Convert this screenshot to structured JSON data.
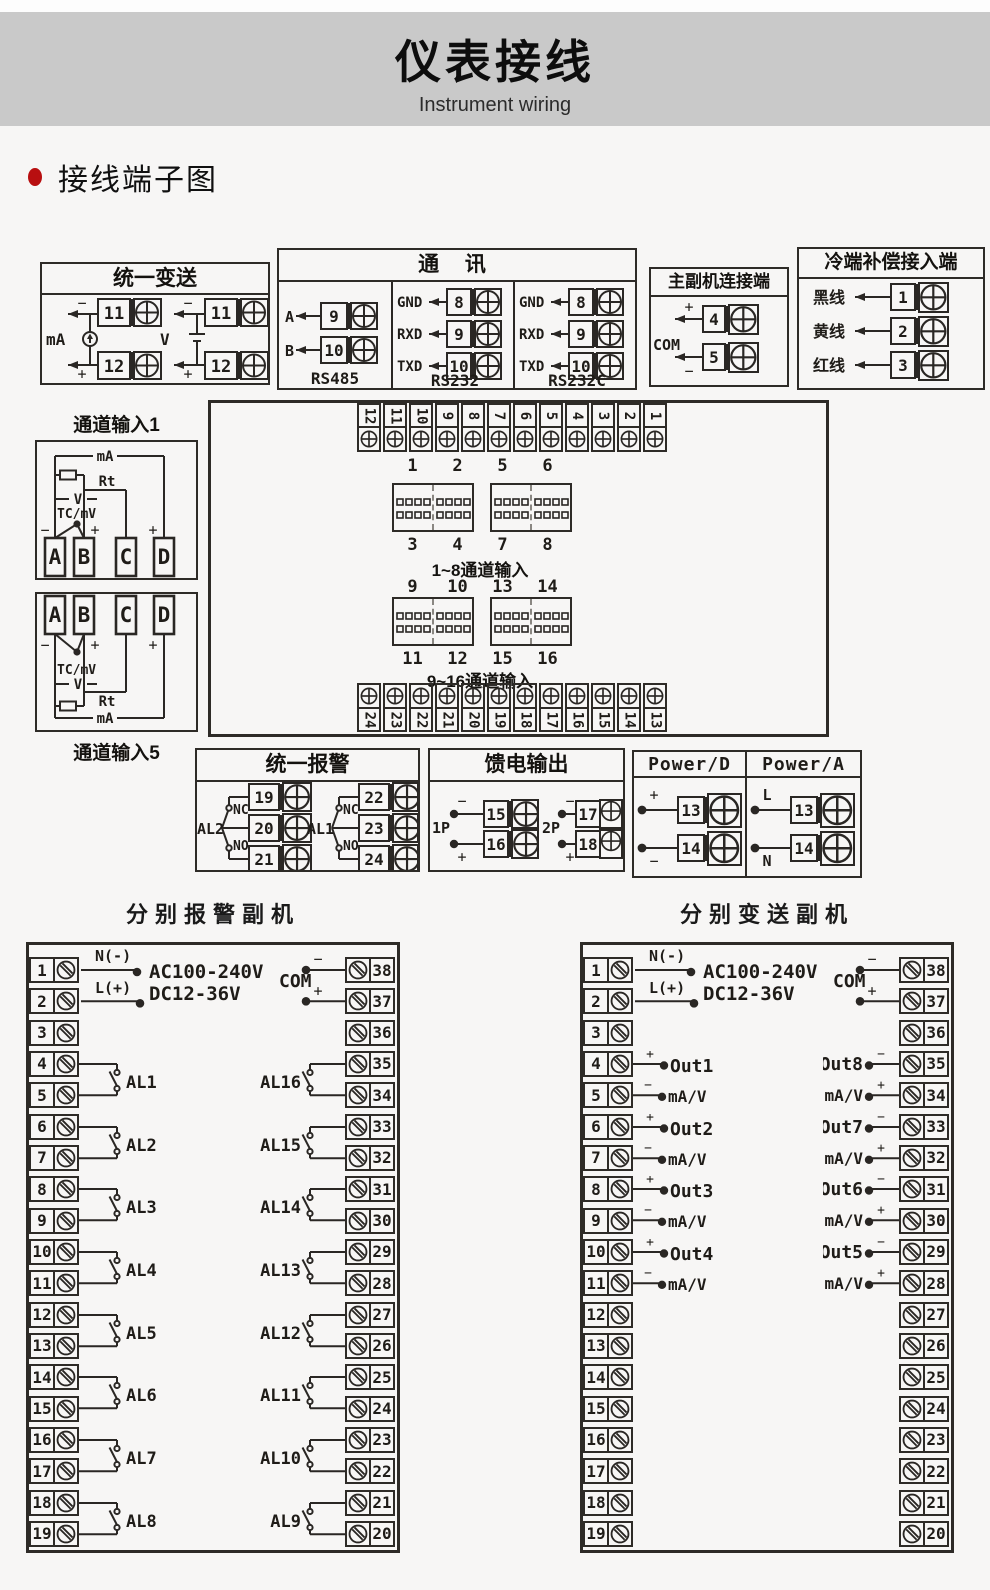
{
  "header": {
    "title": "仪表接线",
    "subtitle": "Instrument wiring"
  },
  "section_title": "接线端子图",
  "boxes": {
    "unified_transmit": {
      "title": "统一变送",
      "ma": {
        "label": "mA",
        "minus": "−",
        "plus": "+",
        "t1": "11",
        "t2": "12"
      },
      "v": {
        "label": "V",
        "minus": "−",
        "plus": "+",
        "t1": "11",
        "t2": "12"
      }
    },
    "comm": {
      "title": "通  讯",
      "rs485": {
        "name": "RS485",
        "rows": [
          {
            "label": "A",
            "num": "9"
          },
          {
            "label": "B",
            "num": "10"
          }
        ]
      },
      "rs232": {
        "name": "RS232",
        "rows": [
          {
            "label": "GND",
            "num": "8"
          },
          {
            "label": "RXD",
            "num": "9"
          },
          {
            "label": "TXD",
            "num": "10"
          }
        ]
      },
      "rs232c": {
        "name": "RS232C",
        "rows": [
          {
            "label": "GND",
            "num": "8"
          },
          {
            "label": "RXD",
            "num": "9"
          },
          {
            "label": "TXD",
            "num": "10"
          }
        ]
      }
    },
    "master_slave": {
      "title": "主副机连接端",
      "com": "COM",
      "plus": "+",
      "minus": "−",
      "t1": "4",
      "t2": "5"
    },
    "cold_comp": {
      "title": "冷端补偿接入端",
      "rows": [
        {
          "label": "黑线",
          "num": "1"
        },
        {
          "label": "黄线",
          "num": "2"
        },
        {
          "label": "红线",
          "num": "3"
        }
      ]
    },
    "channel1": {
      "title": "通道输入1",
      "ma": "mA",
      "rt": "Rt",
      "v": "V",
      "tc": "TC/mV",
      "minus": "−",
      "plus_b": "+",
      "plus_d": "+",
      "a": "A",
      "b": "B",
      "c": "C",
      "d": "D"
    },
    "channel5": {
      "title": "通道输入5",
      "ma": "mA",
      "rt": "Rt",
      "v": "V",
      "tc": "TC/mV",
      "minus": "−",
      "plus_b": "+",
      "plus_d": "+",
      "a": "A",
      "b": "B",
      "c": "C",
      "d": "D"
    },
    "mainboard": {
      "top_strip": [
        "12",
        "11",
        "10",
        "9",
        "8",
        "7",
        "6",
        "5",
        "4",
        "3",
        "2",
        "1"
      ],
      "bottom_strip": [
        "24",
        "23",
        "22",
        "21",
        "20",
        "19",
        "18",
        "17",
        "16",
        "15",
        "14",
        "13"
      ],
      "row1_top": [
        "1",
        "2",
        "5",
        "6"
      ],
      "row1_bottom": [
        "3",
        "4",
        "7",
        "8"
      ],
      "row1_caption": "1~8通道输入",
      "row2_top": [
        "9",
        "10",
        "13",
        "14"
      ],
      "row2_bottom": [
        "11",
        "12",
        "15",
        "16"
      ],
      "row2_caption": "9~16通道输入"
    },
    "unified_alarm": {
      "title": "统一报警",
      "g1": {
        "label": "AL2",
        "nc": "NC",
        "no": "NO",
        "t1": "19",
        "t2": "20",
        "t3": "21"
      },
      "g2": {
        "label": "AL1",
        "nc": "NC",
        "no": "NO",
        "t1": "22",
        "t2": "23",
        "t3": "24"
      }
    },
    "feed_output": {
      "title": "馈电输出",
      "g1": {
        "label": "1P",
        "minus": "−",
        "plus": "+",
        "t1": "15",
        "t2": "16"
      },
      "g2": {
        "label": "2P",
        "minus": "−",
        "plus": "+",
        "t1": "17",
        "t2": "18"
      }
    },
    "power": {
      "d_title": "Power/D",
      "a_title": "Power/A",
      "d": {
        "plus": "+",
        "minus": "−",
        "t1": "13",
        "t2": "14"
      },
      "a": {
        "l": "L",
        "n": "N",
        "t1": "13",
        "t2": "14"
      }
    }
  },
  "alarm_slave": {
    "title": "分别报警副机",
    "left_terminals": [
      "1",
      "2",
      "3",
      "4",
      "5",
      "6",
      "7",
      "8",
      "9",
      "10",
      "11",
      "12",
      "13",
      "14",
      "15",
      "16",
      "17",
      "18",
      "19"
    ],
    "right_terminals": [
      "38",
      "37",
      "36",
      "35",
      "34",
      "33",
      "32",
      "31",
      "30",
      "29",
      "28",
      "27",
      "26",
      "25",
      "24",
      "23",
      "22",
      "21",
      "20"
    ],
    "power": {
      "n_label": "N(-)",
      "l_label": "L(+)",
      "ac": "AC100-240V",
      "dc": "DC12-36V"
    },
    "com": {
      "label": "COM",
      "minus": "−",
      "plus": "+"
    },
    "left_alarms": [
      "AL1",
      "AL2",
      "AL3",
      "AL4",
      "AL5",
      "AL6",
      "AL7",
      "AL8"
    ],
    "right_alarms": [
      "AL16",
      "AL15",
      "AL14",
      "AL13",
      "AL12",
      "AL11",
      "AL10",
      "AL9"
    ]
  },
  "transmit_slave": {
    "title": "分别变送副机",
    "left_terminals": [
      "1",
      "2",
      "3",
      "4",
      "5",
      "6",
      "7",
      "8",
      "9",
      "10",
      "11",
      "12",
      "13",
      "14",
      "15",
      "16",
      "17",
      "18",
      "19"
    ],
    "right_terminals": [
      "38",
      "37",
      "36",
      "35",
      "34",
      "33",
      "32",
      "31",
      "30",
      "29",
      "28",
      "27",
      "26",
      "25",
      "24",
      "23",
      "22",
      "21",
      "20"
    ],
    "power": {
      "n_label": "N(-)",
      "l_label": "L(+)",
      "ac": "AC100-240V",
      "dc": "DC12-36V"
    },
    "com": {
      "label": "COM",
      "minus": "−",
      "plus": "+"
    },
    "left_outs": [
      {
        "plus": "+",
        "minus": "−",
        "label": "Out1",
        "mv": "mA/V"
      },
      {
        "plus": "+",
        "minus": "−",
        "label": "Out2",
        "mv": "mA/V"
      },
      {
        "plus": "+",
        "minus": "−",
        "label": "Out3",
        "mv": "mA/V"
      },
      {
        "plus": "+",
        "minus": "−",
        "label": "Out4",
        "mv": "mA/V"
      }
    ],
    "right_outs": [
      {
        "plus": "+",
        "minus": "−",
        "label": "Out8",
        "mv": "mA/V"
      },
      {
        "plus": "+",
        "minus": "−",
        "label": "Out7",
        "mv": "mA/V"
      },
      {
        "plus": "+",
        "minus": "−",
        "label": "Out6",
        "mv": "mA/V"
      },
      {
        "plus": "+",
        "minus": "−",
        "label": "Out5",
        "mv": "mA/V"
      }
    ]
  }
}
